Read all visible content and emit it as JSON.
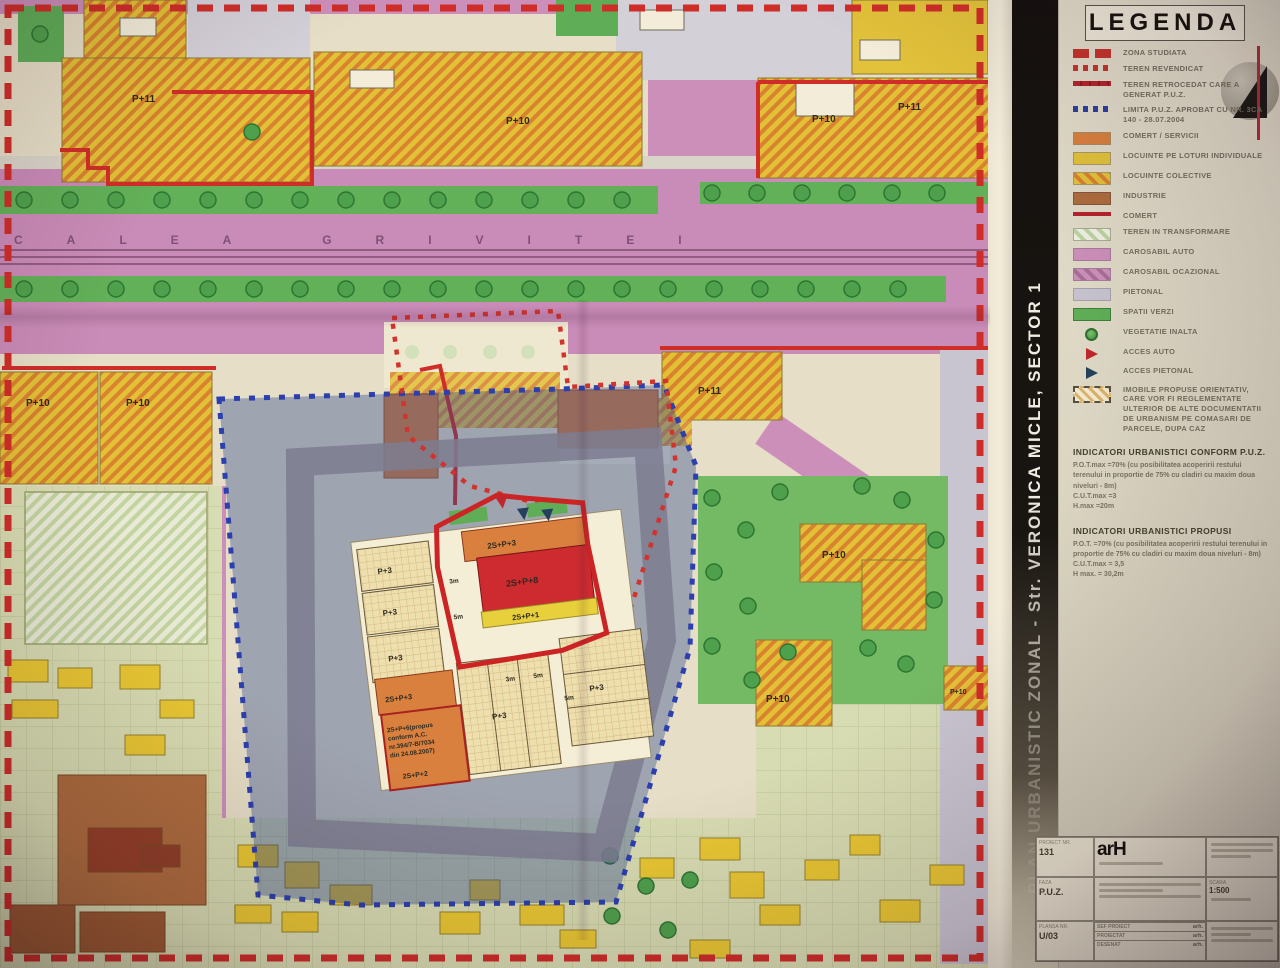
{
  "title_bar": {
    "text": "PLAN URBANISTIC ZONAL - Str. VERONICA MICLE, SECTOR 1"
  },
  "legend": {
    "title": "LEGENDA",
    "items": [
      {
        "label": "ZONA STUDIATA"
      },
      {
        "label": "TEREN REVENDICAT"
      },
      {
        "label": "TEREN RETROCEDAT CARE A GENERAT P.U.Z."
      },
      {
        "label": "LIMITA P.U.Z. APROBAT CU NR. 3CA 140 - 28.07.2004"
      },
      {
        "label": "COMERT / SERVICII"
      },
      {
        "label": "LOCUINTE PE LOTURI INDIVIDUALE"
      },
      {
        "label": "LOCUINTE COLECTIVE"
      },
      {
        "label": "INDUSTRIE"
      },
      {
        "label": "COMERT"
      },
      {
        "label": "TEREN IN TRANSFORMARE"
      },
      {
        "label": "CAROSABIL AUTO"
      },
      {
        "label": "CAROSABIL OCAZIONAL"
      },
      {
        "label": "PIETONAL"
      },
      {
        "label": "SPATII VERZI"
      },
      {
        "label": "VEGETATIE INALTA"
      },
      {
        "label": "ACCES AUTO"
      },
      {
        "label": "ACCES PIETONAL"
      },
      {
        "label": "IMOBILE PROPUSE ORIENTATIV, CARE VOR FI REGLEMENTATE ULTERIOR DE ALTE DOCUMENTATII DE URBANISM PE COMASARI DE PARCELE, DUPA CAZ"
      }
    ],
    "indicators_existing": {
      "heading": "INDICATORI URBANISTICI CONFORM P.U.Z.",
      "lines": [
        "P.O.T.max =70% (cu posibilitatea acoperirii restului terenului in proportie de 75% cu cladiri cu maxim doua niveluri - 8m)",
        "C.U.T.max =3",
        "H.max =20m"
      ]
    },
    "indicators_proposed": {
      "heading": "INDICATORI URBANISTICI PROPUSI",
      "lines": [
        "P.O.T. =70% (cu posibilitatea acoperirii restului terenului in proportie de 75% cu cladiri cu maxim doua niveluri - 8m)",
        "C.U.T.max = 3,5",
        "H max. = 30,2m"
      ]
    }
  },
  "title_block": {
    "project_no_label": "PROIECT NR.",
    "project_no": "131",
    "phase_label": "FAZA",
    "phase": "P.U.Z.",
    "sheet_label": "PLANSA NR.",
    "sheet": "U/03",
    "scale_label": "SCARA",
    "scale": "1:500",
    "logo_text": "arH",
    "rows": [
      {
        "role": "SEF PROIECT",
        "name": "arh."
      },
      {
        "role": "PROIECTAT",
        "name": "arh."
      },
      {
        "role": "DESENAT",
        "name": "arh."
      }
    ]
  },
  "map": {
    "street_name": "CALEA GRIVITEI",
    "labels": [
      {
        "text": "P+11"
      },
      {
        "text": "P+10"
      },
      {
        "text": "P+10"
      },
      {
        "text": "P+11"
      },
      {
        "text": "P+10"
      },
      {
        "text": "P+10"
      },
      {
        "text": "P+11"
      },
      {
        "text": "P+10"
      },
      {
        "text": "P+10"
      },
      {
        "text": "P+10"
      },
      {
        "text": "P+3"
      },
      {
        "text": "P+3"
      },
      {
        "text": "P+3"
      },
      {
        "text": "2S+P+3"
      },
      {
        "text": "2S+P+8"
      },
      {
        "text": "2S+P+1"
      },
      {
        "text": "2S+P+3"
      },
      {
        "text": "2S+P+2"
      },
      {
        "text": "P+3"
      },
      {
        "text": "P+3"
      }
    ],
    "annotation": [
      "2S+P+6(propus",
      "conform A.C.",
      "nr.394/7-B/7034",
      "din 24.08.2007)"
    ],
    "dims": [
      "3m",
      "5m",
      "3m",
      "5m",
      "5m"
    ]
  },
  "colors": {
    "zona_red": "#c6332c",
    "limita_blue": "#2c3f9f",
    "carosabil_pink": "#cc8fba",
    "locuinte_yellow": "#e2c23a",
    "comert_orange": "#d9803f",
    "spatii_green": "#5fae57",
    "industrie_brown": "#ad6c3e",
    "pietonal_lavender": "#c6c2ce",
    "paper_cream": "#e6dec6"
  }
}
